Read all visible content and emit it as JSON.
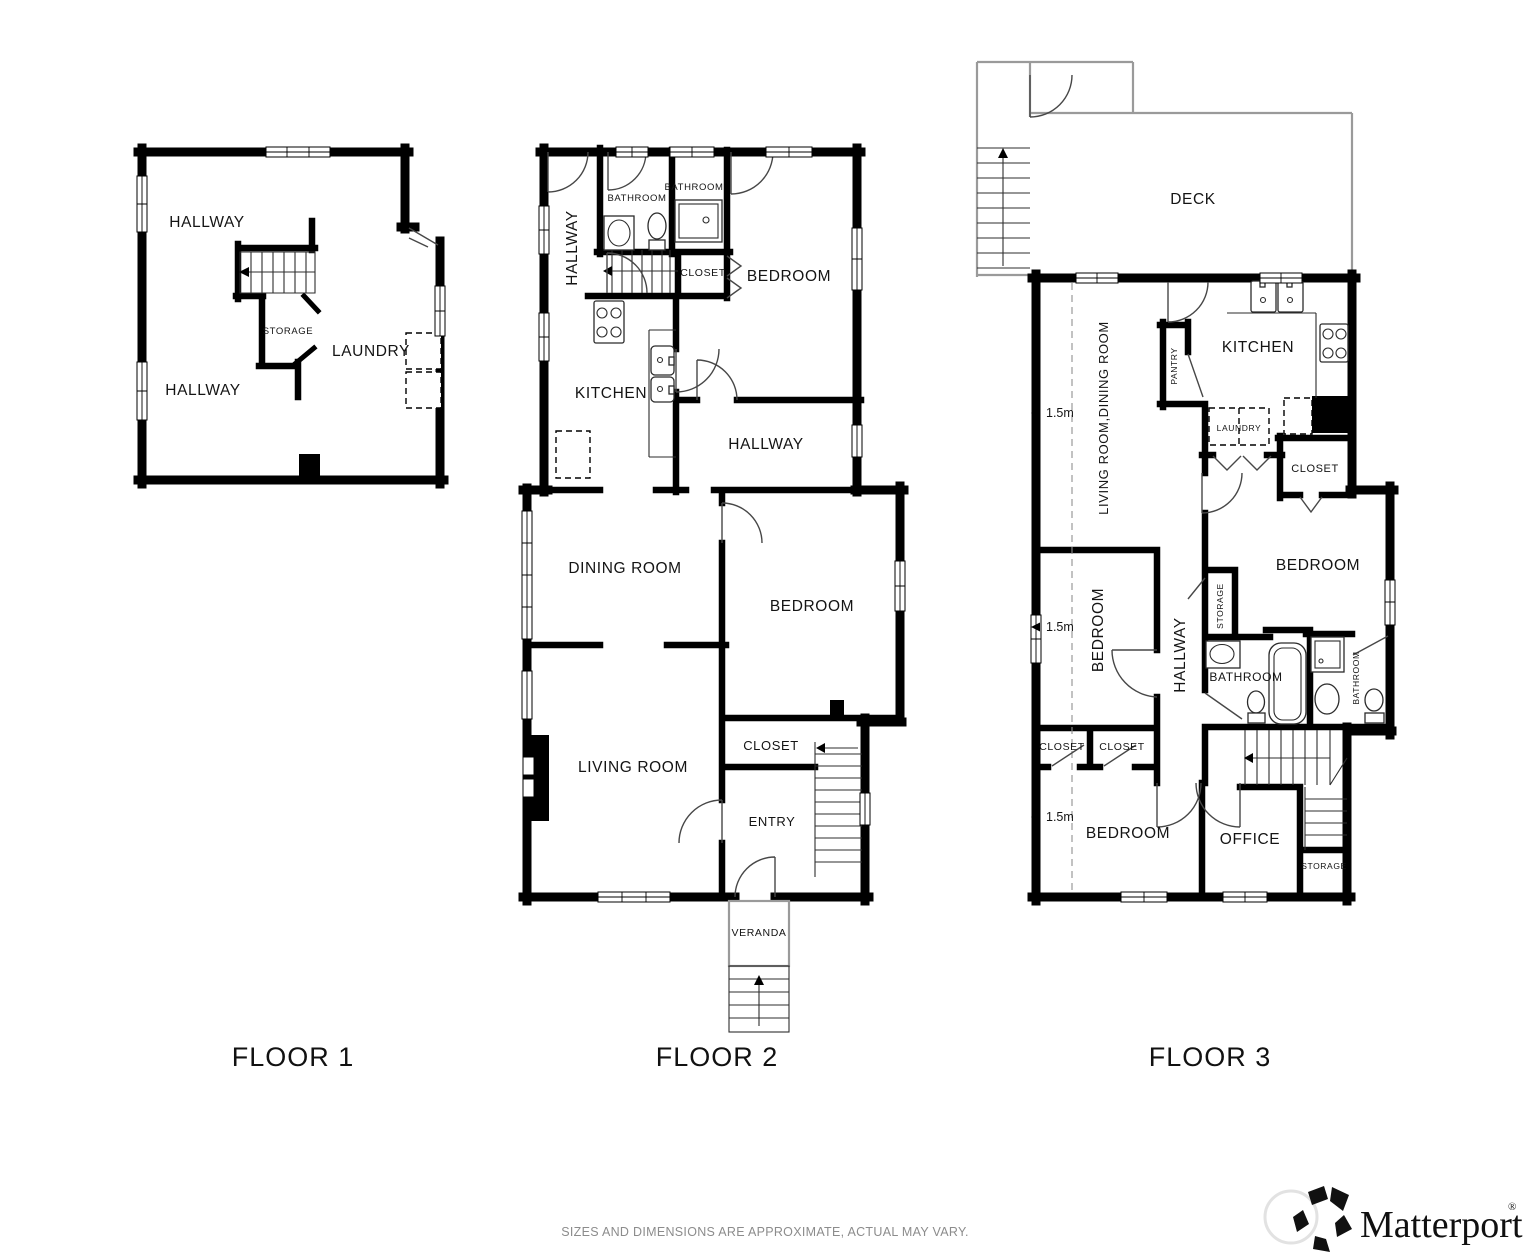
{
  "page": {
    "type": "floor-plan",
    "colors": {
      "background": "#ffffff",
      "walls": "#000000",
      "deck_outline": "#9a9a9a",
      "disclaimer_text": "#8c8c8c"
    }
  },
  "floor1": {
    "title": "FLOOR 1",
    "labels": {
      "hallway_upper": "HALLWAY",
      "hallway_lower": "HALLWAY",
      "storage": "STORAGE",
      "laundry": "LAUNDRY"
    }
  },
  "floor2": {
    "title": "FLOOR 2",
    "labels": {
      "hallway": "HALLWAY",
      "bathroom_left": "BATHROOM",
      "bathroom_right": "BATHROOM",
      "closet_upper": "CLOSET",
      "bedroom_upper": "BEDROOM",
      "kitchen": "KITCHEN",
      "hallway_mid": "HALLWAY",
      "dining_room": "DINING ROOM",
      "bedroom_lower": "BEDROOM",
      "living_room": "LIVING ROOM",
      "closet_lower": "CLOSET",
      "entry": "ENTRY",
      "veranda": "VERANDA"
    }
  },
  "floor3": {
    "title": "FLOOR 3",
    "labels": {
      "deck": "DECK",
      "living_dining": "LIVING ROOM,DINING ROOM",
      "pantry": "PANTRY",
      "kitchen": "KITCHEN",
      "laundry": "LAUNDRY",
      "closet_kitchen": "CLOSET",
      "bedroom_right": "BEDROOM",
      "storage_bedroom": "STORAGE",
      "bedroom_left": "BEDROOM",
      "hallway": "HALLWAY",
      "bathroom_main": "BATHROOM",
      "bathroom_ensuite": "BATHROOM",
      "closet_left": "CLOSET",
      "closet_mid": "CLOSET",
      "bedroom_lower": "BEDROOM",
      "office": "OFFICE",
      "storage_office": "STORAGE",
      "ceiling_height": "1.5m"
    }
  },
  "footer": {
    "disclaimer": "SIZES AND DIMENSIONS ARE APPROXIMATE, ACTUAL MAY VARY.",
    "brand": "Matterport",
    "registered_mark": "®"
  }
}
